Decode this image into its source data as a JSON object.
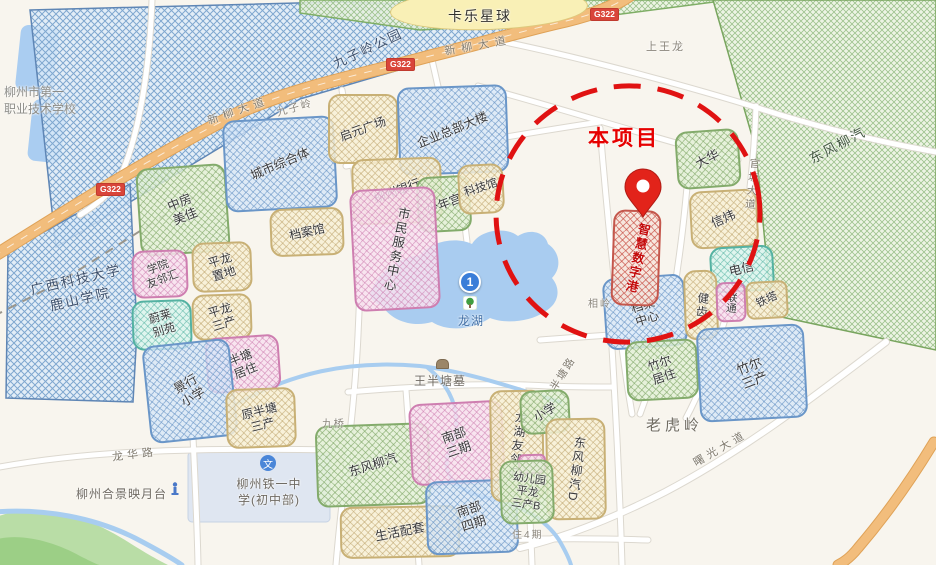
{
  "project": {
    "callout": "本项目"
  },
  "roads": {
    "g322": "G322",
    "xinliu": "新柳大道",
    "guantang": "官塘大道",
    "shuguang": "曙光大道",
    "longhua": "龙华路",
    "bantang": "半塘路",
    "jiuqiao": "九桥"
  },
  "villages": {
    "shangwanglong": "上王龙",
    "xiangling": "相岭",
    "laohuling": "老虎岭",
    "jiuziling": "九子岭",
    "zhu4qi": "住4期"
  },
  "big_zones": {
    "jiuziling_park": {
      "label": "九子岭公园"
    },
    "kale_planet": {
      "label": "卡乐星球"
    },
    "gxust": {
      "lines": [
        "广西科技大学",
        "鹿山学院"
      ]
    },
    "dongfeng_liuqi_east": {
      "label": "东风柳汽"
    },
    "liuzhou_no1_vocational": {
      "lines": [
        "柳州市第一",
        "职业技术学校"
      ]
    }
  },
  "parcels": {
    "zhongfang_meijia": {
      "lines": [
        "中房",
        "美佳"
      ]
    },
    "chengshi_zongheti": {
      "label": "城市综合体"
    },
    "qiyuan_plaza": {
      "label": "启元广场"
    },
    "qiye_zongbu_dalou": {
      "label": "企业总部大楼"
    },
    "liuzhou_bank": {
      "label": "柳州银行"
    },
    "shaoniangong": {
      "label": "少年宫"
    },
    "kejiguan": {
      "label": "科技馆"
    },
    "danganguan": {
      "label": "档案馆"
    },
    "shimin_fuwu_zhongxin": {
      "label": "市民服务中心"
    },
    "xueyuan_youlinhui": {
      "lines": [
        "学院",
        "友邻汇"
      ]
    },
    "pinglong_zhidi": {
      "lines": [
        "平龙",
        "置地"
      ]
    },
    "pinglong_sanchan": {
      "lines": [
        "平龙",
        "三产"
      ]
    },
    "weilai_bieyuan": {
      "lines": [
        "蔚莱",
        "别苑"
      ]
    },
    "bantang_juzhu": {
      "lines": [
        "半塘",
        "居住"
      ]
    },
    "jingxing_xiaoxue": {
      "lines": [
        "景行",
        "小学"
      ]
    },
    "yuan_bantang_sanchan": {
      "lines": [
        "原半塘",
        "三产"
      ]
    },
    "dongfeng_liuqi_sw": {
      "label": "东风柳汽"
    },
    "shenghuo_peitao": {
      "label": "生活配套"
    },
    "nanbu_sanqi": {
      "lines": [
        "南部",
        "三期"
      ]
    },
    "nanbu_siqi": {
      "lines": [
        "南部",
        "四期"
      ]
    },
    "longhu_youlinhui": {
      "label": "龙湖友邻汇"
    },
    "xiaoxue": {
      "label": "小学"
    },
    "dongfeng_liuqi_d": {
      "label": "东风柳汽D"
    },
    "youeryuan": {
      "lines": [
        "幼儿园",
        "平龙",
        "三产B"
      ]
    },
    "zhihui_shuzigang": {
      "label": "智慧数字港"
    },
    "dangan_zhongxin": {
      "lines": [
        "档案",
        "中心"
      ]
    },
    "dahua": {
      "label": "大华"
    },
    "xinwei": {
      "label": "信炜"
    },
    "dianxin": {
      "label": "电信"
    },
    "jianchi": {
      "label": "健齿"
    },
    "liantong": {
      "label": "联通"
    },
    "tieta": {
      "label": "铁塔"
    },
    "zhuer_juzhu": {
      "lines": [
        "竹尔",
        "居住"
      ]
    },
    "zhuer_sanchan": {
      "lines": [
        "竹尔",
        "三产"
      ]
    }
  },
  "pois": {
    "longhu": {
      "label": "龙湖",
      "marker": "1"
    },
    "wangbantang_tomb": {
      "label": "王半塘墓"
    },
    "hejing": {
      "label": "柳州合景映月台"
    },
    "tieyi_school": {
      "lines": [
        "柳州铁一中",
        "学(初中部)"
      ]
    }
  },
  "colors": {
    "project_red": "#e60000",
    "circle_red": "#e01212",
    "road_orange": "#f2bd7c",
    "water": "#a9ccf0"
  }
}
